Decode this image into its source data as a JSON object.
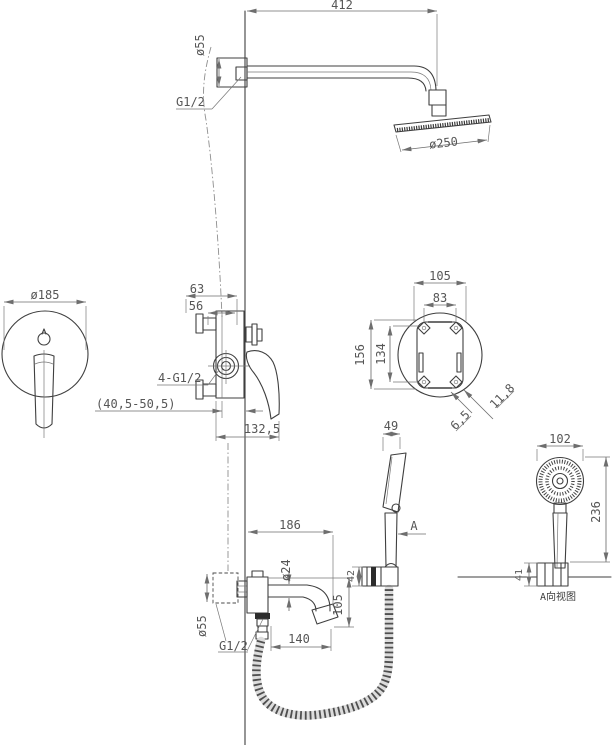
{
  "drawing": {
    "caption_view_a": "A向视图",
    "view_label": "A",
    "colors": {
      "outline": "#3f3f3f",
      "dimension": "#6e6e6e",
      "text": "#565656",
      "dark_fill": "#2c2c2c",
      "background": "#ffffff"
    },
    "dims": {
      "arm_length": "412",
      "arm_flange_dia": "ø55",
      "arm_thread": "G1/2",
      "head_dia": "ø250",
      "trim_dia": "ø185",
      "valve_offset_a": "63",
      "valve_offset_b": "56",
      "valve_ports": "4-G1/2",
      "wall_depth_range": "(40,5-50,5)",
      "valve_width": "132,5",
      "box_hole_spacing_h": "105",
      "box_width": "83",
      "box_hole_spacing_v": "156",
      "box_height": "134",
      "box_corner_offset_a": "11,8",
      "box_corner_offset_b": "6,5",
      "handshower_head_width": "49",
      "holder_depth": "42",
      "spout_total_reach": "186",
      "spout_dia": "ø24",
      "spout_drop": "105",
      "spout_reach": "140",
      "spout_thread": "G1/2",
      "spout_flange_dia": "ø55",
      "aview_head_dia": "102",
      "aview_length": "236",
      "aview_holder_width": "41"
    }
  }
}
